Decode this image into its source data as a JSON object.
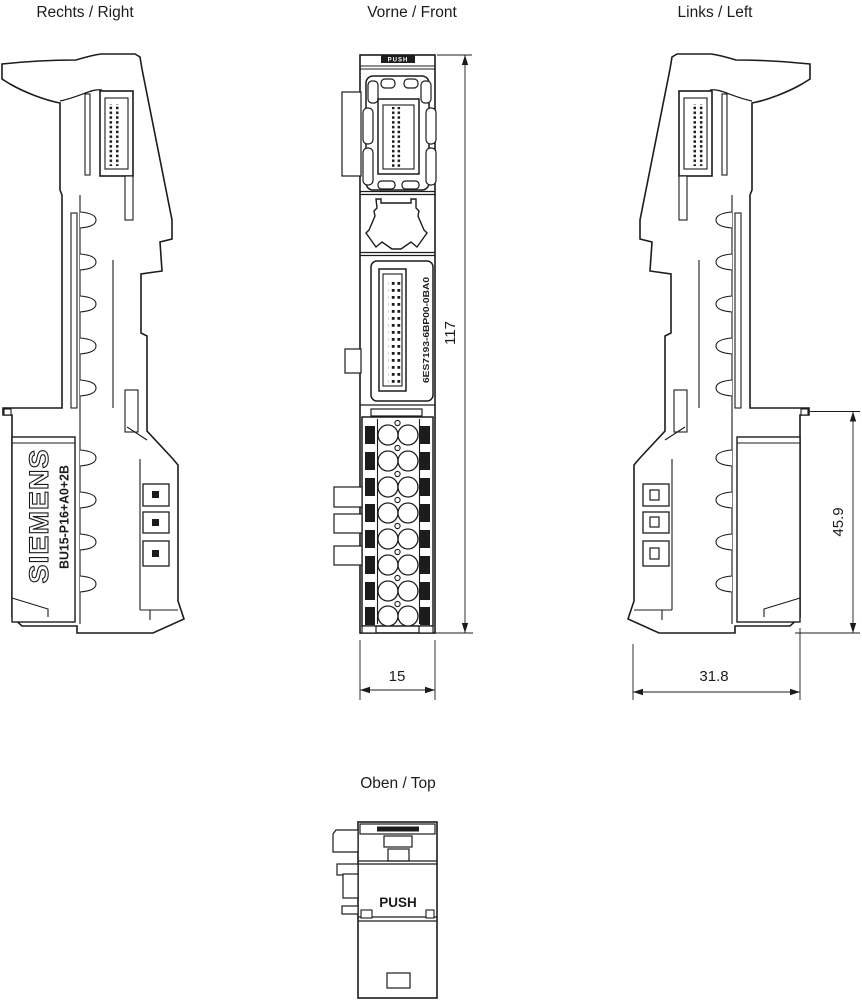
{
  "views": {
    "right": {
      "label": "Rechts / Right",
      "brand": "SIEMENS",
      "model": "BU15-P16+A0+2B"
    },
    "front": {
      "label": "Vorne / Front",
      "push_label": "PUSH",
      "part_number": "6ES7193-6BP00-0BA0"
    },
    "left": {
      "label": "Links / Left"
    },
    "top": {
      "label": "Oben / Top",
      "push_label": "PUSH"
    }
  },
  "dimensions": {
    "height": "117",
    "width": "15",
    "rear_height": "45.9",
    "depth": "31.8"
  },
  "colors": {
    "line": "#1c1c1c",
    "background": "#ffffff"
  }
}
